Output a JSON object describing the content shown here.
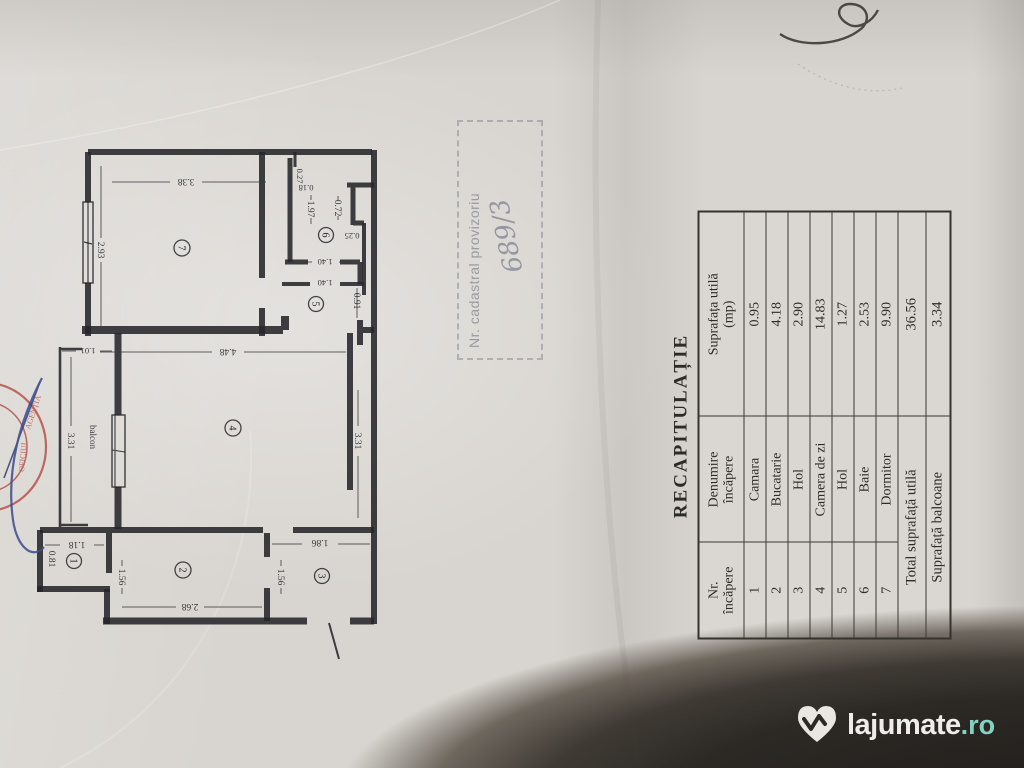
{
  "recap_table": {
    "title": "RECAPITULAȚIE",
    "col_headers": {
      "nr1": "Nr.",
      "nr2": "încăpere",
      "den1": "Denumire",
      "den2": "încăpere",
      "sup1": "Suprafața utilă",
      "sup2": "(mp)"
    },
    "rows": [
      {
        "nr": "1",
        "name": "Camara",
        "area": "0.95"
      },
      {
        "nr": "2",
        "name": "Bucatarie",
        "area": "4.18"
      },
      {
        "nr": "3",
        "name": "Hol",
        "area": "2.90"
      },
      {
        "nr": "4",
        "name": "Camera de zi",
        "area": "14.83"
      },
      {
        "nr": "5",
        "name": "Hol",
        "area": "1.27"
      },
      {
        "nr": "6",
        "name": "Baie",
        "area": "2.53"
      },
      {
        "nr": "7",
        "name": "Dormitor",
        "area": "9.90"
      }
    ],
    "total_label": "Total suprafață utilă",
    "total_value": "36.56",
    "balcony_label": "Suprafață balcoane",
    "balcony_value": "3.34"
  },
  "cadastral_stamp": {
    "line": "Nr. cadastral provizoriu",
    "number": "689/3"
  },
  "red_stamp": {
    "word1": "AGENȚIA",
    "word2": "OFICIUL"
  },
  "plan": {
    "balcony_label": "balcon",
    "rooms": {
      "r1": "1",
      "r2": "2",
      "r3": "3",
      "r4": "4",
      "r5": "5",
      "r6": "6",
      "r7": "7"
    },
    "dims": {
      "d338": "3.38",
      "d293": "2.93",
      "d027": "0.27",
      "d018": "0.18",
      "d197": "1.97",
      "d072": "0.72",
      "d025": "0.25",
      "d140a": "1.40",
      "d140b": "1.40",
      "d091": "0.91",
      "d448": "4.48",
      "d101": "1.01",
      "d331l": "3.31",
      "d331r": "3.31",
      "d118": "1.18",
      "d081": "0.81",
      "d156a": "1.56",
      "d268": "2.68",
      "d156b": "1.56",
      "d186": "1.86"
    }
  },
  "watermark": {
    "brand": "lajumate",
    "tld": ".ro"
  },
  "colors": {
    "ink": "#26262a",
    "paper": "#d8d5d0",
    "stamp_gray": "#878995",
    "stamp_red": "#b44a42",
    "pen_blue": "#3b4a8c",
    "watermark_dark": "#2c2925",
    "watermark_teal": "#85d2c2"
  }
}
